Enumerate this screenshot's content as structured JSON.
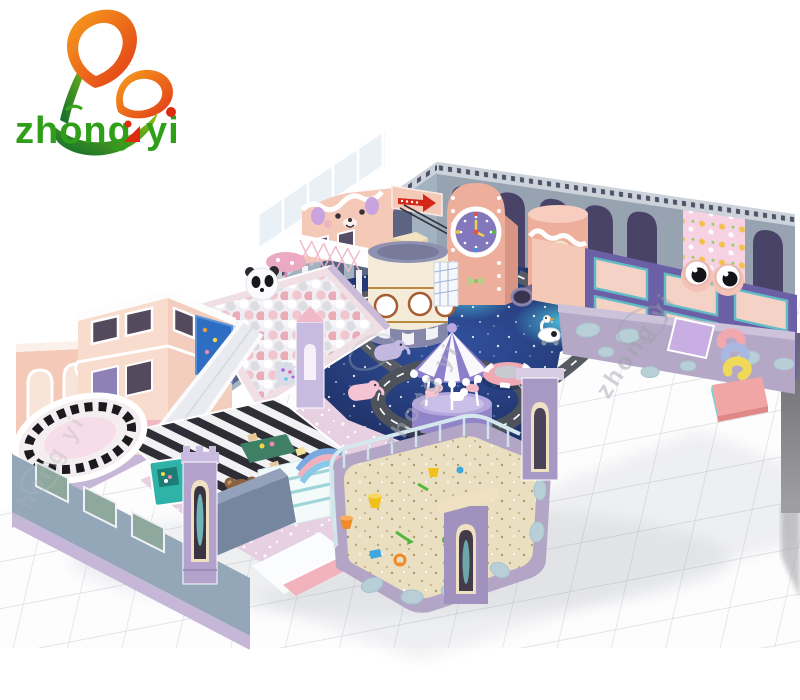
{
  "logo": {
    "brand": "zhong yi",
    "word1": "zhong",
    "word2": "yi"
  },
  "watermark": {
    "text": "zhong yi"
  },
  "colors": {
    "background": "#ffffff",
    "grid_line": "#d8d9de",
    "logo_green": "#2f9f1a",
    "logo_red": "#e02a10",
    "wall_blue_gray": "#a2b2c1",
    "wall_arch_slate": "#5d6382",
    "wall_arch_purple": "#494368",
    "trim_light": "#cdd3da",
    "facade_pink": "#f4c9b8",
    "arrow_red": "#d42718",
    "clock_tower_salmon": "#eeae9c",
    "clock_face_purple": "#8478bc",
    "tower_cream": "#f4ecd8",
    "tower_base_purple": "#8486aa",
    "tube_purple": "#6d6894",
    "galaxy_navy": "#141d45",
    "road_gray": "#575c64",
    "carousel_purple": "#8d7ecc",
    "ballpit_wall_pink": "#f1dfe6",
    "playhouse_pink": "#f3cdbd",
    "playhouse_pink_light": "#f8dccd",
    "screen_blue": "#2e6ec2",
    "slide_gray": "#e9ebf0",
    "floor_pink": "#e6d0e2",
    "sand_tan": "#eadfc0",
    "sand_wall_lavender": "#b3a5c6",
    "railing_blue": "#d4e8ee",
    "tramp_wall_purple": "#6b60a6",
    "tramp_mat_pink": "#f5d2c6",
    "mat_teal": "#62bcc6",
    "front_wall_lavender": "#b5a8c6",
    "cloud_blue": "#b9cfd8",
    "bear_brown": "#8a6240",
    "counter_blue": "#76869f",
    "castle_lavender": "#b3a2cc",
    "door_cream": "#efe1c2",
    "pit_navy": "#232650",
    "west_wall": "#9db0c0",
    "south_wall": "#93a7b8",
    "window_green": "#8fa89d",
    "base_lavender": "#c6b7d8",
    "gray_band": "#6c6c70",
    "watermark_gray": "#9aa0a8"
  },
  "scene": {
    "areas": [
      "brand-logo",
      "ball-pit",
      "toddler-playhouse",
      "projection-screen",
      "straight-slide",
      "building-blocks-area",
      "piano-stage",
      "carousel",
      "ring-road",
      "galaxy-carpet",
      "clock-tower",
      "tube-slide-tower",
      "lattice-bridge",
      "zipline",
      "bear-face-facade",
      "arrow-sign",
      "net-play-frame",
      "donut-trampoline",
      "swan-ride",
      "elephant-rides",
      "sand-pit",
      "sand-toys",
      "castle-gate",
      "reception-counter",
      "teddy-bear",
      "shoe-shelf",
      "trampoline-wall",
      "googly-eyes",
      "cat-wallpaper",
      "soft-blocks",
      "crash-mat",
      "tile-floor",
      "watermark"
    ]
  }
}
